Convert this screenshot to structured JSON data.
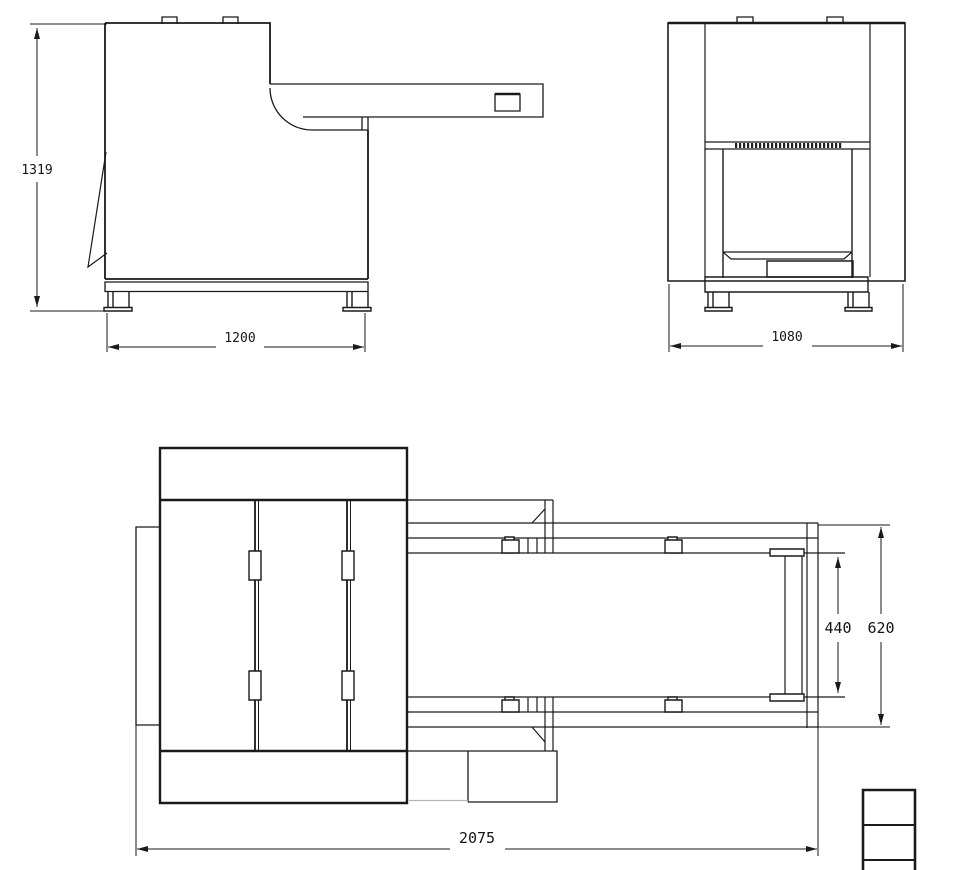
{
  "dims": {
    "side_height": "1319",
    "side_width": "1200",
    "front_width": "1080",
    "belt_width": "440",
    "conveyor_width": "620",
    "overall_length": "2075"
  },
  "colors": {
    "line": "#1a1a1a",
    "accent_red": "#ff0000",
    "legend_border": "#4a4a4a"
  }
}
